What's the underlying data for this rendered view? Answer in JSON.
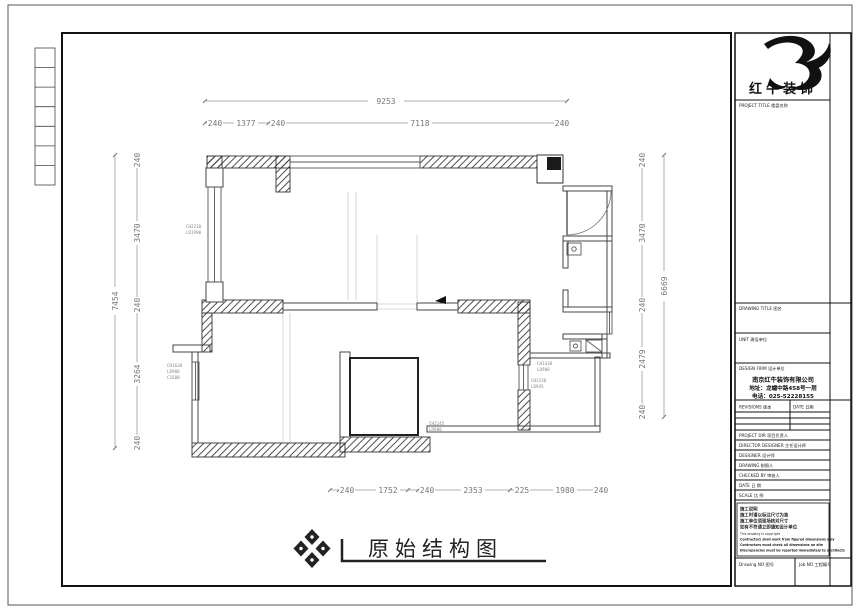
{
  "brand": {
    "logo_text": "红牛装饰",
    "ink_color": "#1a1a1a"
  },
  "drawing": {
    "title": "原始结构图"
  },
  "dims": {
    "top_total": "9253",
    "top": [
      "240",
      "1377",
      "240",
      "7118",
      "240"
    ],
    "left_total": "7454",
    "left": [
      "240",
      "3470",
      "240",
      "3264",
      "240"
    ],
    "right_total": "6669",
    "right": [
      "240",
      "3470",
      "240",
      "2479",
      "240"
    ],
    "bottom": [
      "240",
      "1752",
      "240",
      "2353",
      "225",
      "1980",
      "240"
    ]
  },
  "window_labels": {
    "left_upper": [
      "CH2210",
      "LD1990"
    ],
    "left_lower": [
      "CH1630",
      "LD980",
      "C1600"
    ],
    "right_upper": [
      "CH1430",
      "LD900"
    ],
    "right_lower": [
      "CH1530",
      "LD945"
    ],
    "bottom_room": [
      "CH2245",
      "LD900"
    ]
  },
  "title_block": {
    "project_title_label": "PROJECT TITLE  楼盘名称",
    "drawing_title_label": "DRAWING TITLE  图名",
    "unit_label": "UNIT  建设单位",
    "design_firm_label": "DESIGN FIRM  设计单位",
    "company": {
      "name": "南京红牛装饰有限公司",
      "address": "地址：龙蟠中路458号一层",
      "phone": "电话：025-52228155"
    },
    "revisions_label": "REVISIONS  版本",
    "date_col_label": "DATE  日期",
    "staff_rows": [
      "PROJECT DIR  项目负责人",
      "DIRECTOR DESIGNER  主任设计师",
      "DESIGNER  设计师",
      "DRAWING  制图人",
      "CHECKED BY  审核人",
      "DATE  日  期",
      "SCALE  比  例"
    ],
    "notes": [
      "施工说明",
      "施工时请以标注尺寸为准",
      "施工单位须现场核对尺寸",
      "如有不符请立即通知设计单位",
      "This drawing is copyright",
      "Contractors shall work from figured dimensions only",
      "Contractors must check all dimensions on site",
      "Discrepancies must be reported immediately to architects"
    ],
    "drawing_no_label": "Drawing NO  图号",
    "job_no_label": "Job NO  工程编号"
  }
}
